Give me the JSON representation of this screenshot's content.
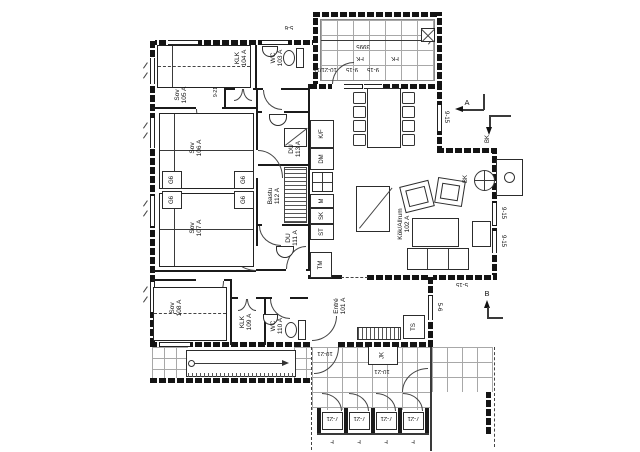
{
  "rooms": {
    "sov105": {
      "name": "Sov",
      "num": "105 A"
    },
    "klk104": {
      "name": "KLK",
      "num": "104 A"
    },
    "wc103": {
      "name": "WC",
      "num": "103 A"
    },
    "sov106": {
      "name": "Sov",
      "num": "106 A"
    },
    "sov107": {
      "name": "Sov",
      "num": "107 A"
    },
    "sov108": {
      "name": "Sov",
      "num": "108 A"
    },
    "klk109": {
      "name": "KLK",
      "num": "109 A"
    },
    "wc110": {
      "name": "WC",
      "num": "110 A"
    },
    "bastu112": {
      "name": "Bastu",
      "num": "112 A"
    },
    "du113": {
      "name": "DU",
      "num": "113 A"
    },
    "du111": {
      "name": "DU",
      "num": "111 A"
    },
    "entre101": {
      "name": "Entré",
      "num": "101 A"
    },
    "kok102": {
      "name": "Kök/Allrum",
      "num": "102 A"
    }
  },
  "wardrobe_label": "G6",
  "kitchen_units": {
    "fridge_freezer": "K/F",
    "dishwasher": "DM",
    "micro": "M",
    "pantry": "SK",
    "cleaning": "ST"
  },
  "laundry": {
    "washer": "TM",
    "drying_cabinet": "TS"
  },
  "outdoor": {
    "jk": "JK"
  },
  "deck": {
    "length": "3995",
    "vent": "FK"
  },
  "fireplace_label": "BK",
  "sections": {
    "a": "A",
    "b": "B",
    "bk": "BK"
  },
  "dims": {
    "w9_15": "9-15",
    "w5_6": "5-6",
    "w5_15": "5-15",
    "d10_21": "10-21",
    "d10_21_15": "10-21/15",
    "d7_21": "7-21",
    "panel_f": "F",
    "door8_21": "8-21",
    "door9_21": "9-21"
  }
}
